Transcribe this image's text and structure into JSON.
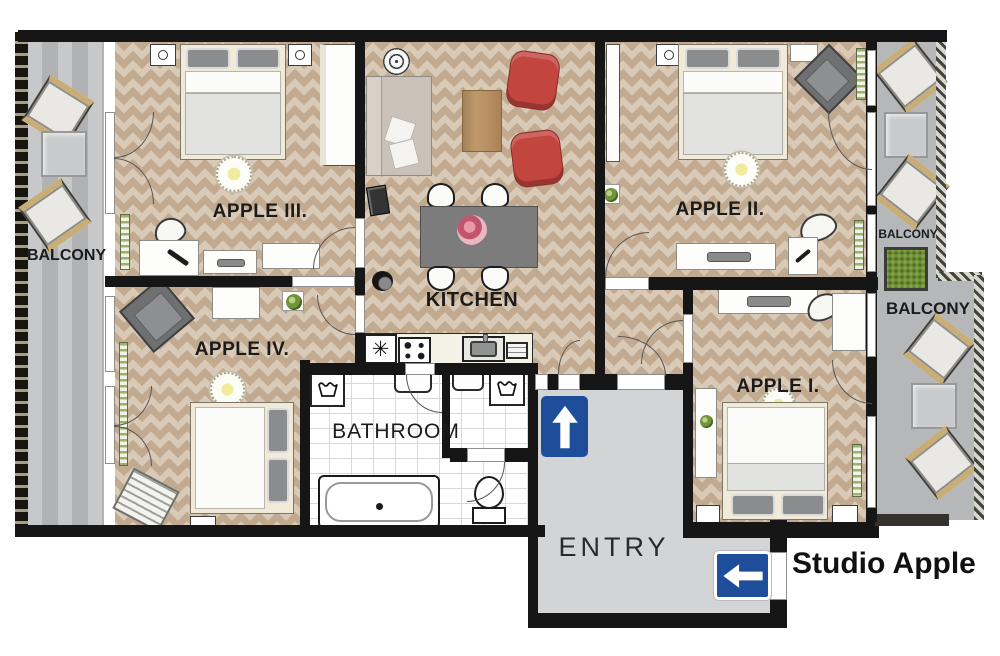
{
  "title": "Studio Apple",
  "rooms": {
    "apple_i": {
      "label": "APPLE I."
    },
    "apple_ii": {
      "label": "APPLE II."
    },
    "apple_iii": {
      "label": "APPLE III."
    },
    "apple_iv": {
      "label": "APPLE IV."
    },
    "kitchen": {
      "label": "KITCHEN"
    },
    "bathroom": {
      "label": "BATHROOM"
    },
    "entry": {
      "label": "ENTRY"
    },
    "balcony_left": {
      "label": "BALCONY"
    },
    "balcony_top_right": {
      "label": "BALCONY"
    },
    "balcony_right": {
      "label": "BALCONY"
    }
  },
  "icons": {
    "fridge_symbol": "✳"
  },
  "colors": {
    "wall": "#161616",
    "floor_parquet": "#d9cab7",
    "floor_parquet_accent": "#c2aa91",
    "balcony_gray": "#b6b7b8",
    "entry_gray": "#d3d4d5",
    "sign_blue": "#1e4e9a",
    "armchair_red": "#c2453e",
    "sofa_beige": "#cac1b8",
    "table_wood": "#b08d5f",
    "radiator_green": "#9db06f",
    "bed_frame_cream": "#f1ead8",
    "label_text": "#1b1b1b"
  }
}
